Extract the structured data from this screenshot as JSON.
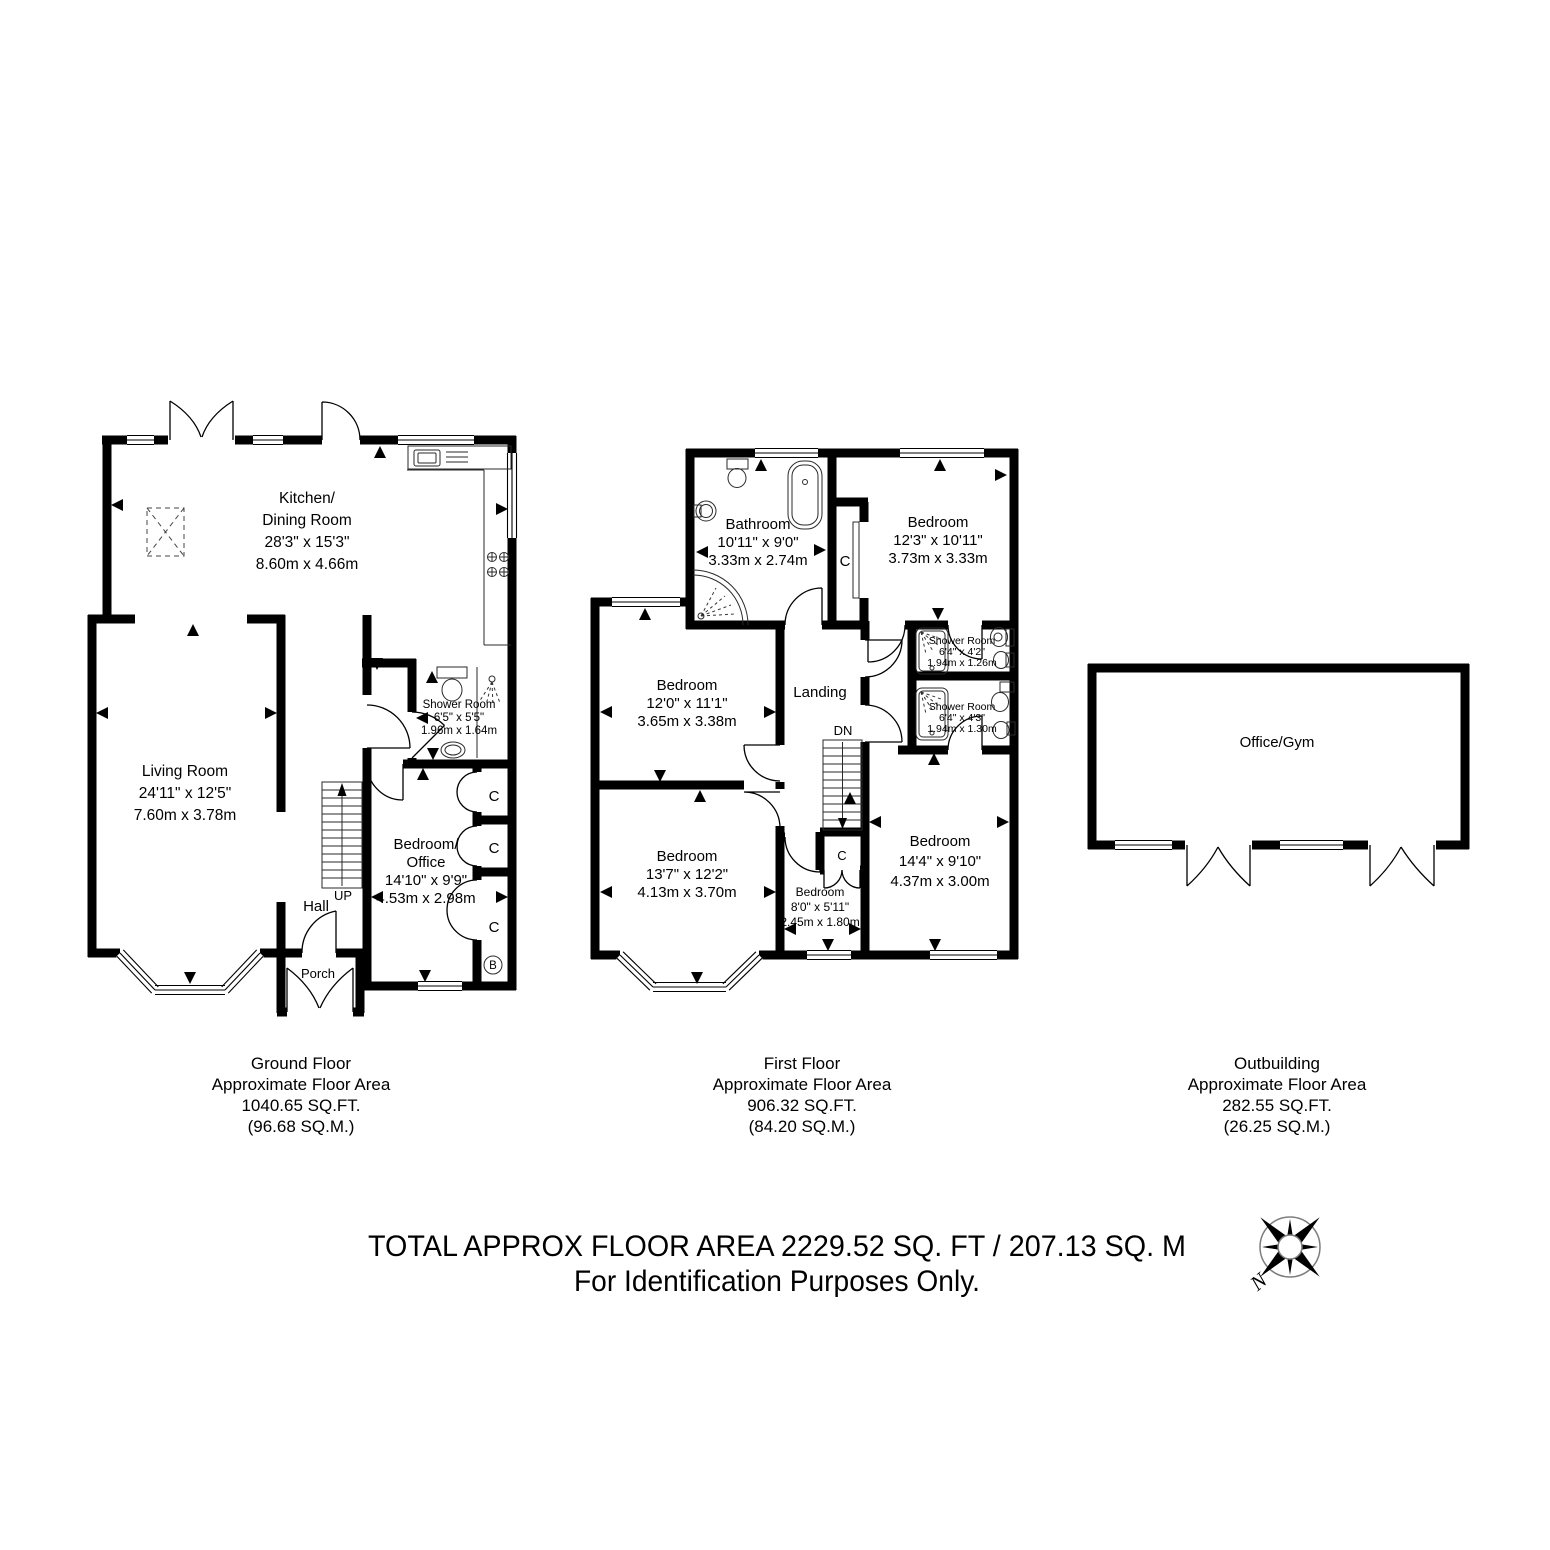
{
  "ground_floor": {
    "caption": {
      "title": "Ground Floor",
      "subtitle": "Approximate Floor Area",
      "area_ft": "1040.65 SQ.FT.",
      "area_m": "(96.68 SQ.M.)"
    },
    "rooms": {
      "kitchen_dining": {
        "name1": "Kitchen/",
        "name2": "Dining Room",
        "imperial": "28'3\" x 15'3\"",
        "metric": "8.60m x 4.66m"
      },
      "living_room": {
        "name": "Living Room",
        "imperial": "24'11\" x 12'5\"",
        "metric": "7.60m x 3.78m"
      },
      "shower_room": {
        "name": "Shower Room",
        "imperial": "6'5\" x 5'5\"",
        "metric": "1.96m x 1.64m"
      },
      "bedroom_office": {
        "name1": "Bedroom/",
        "name2": "Office",
        "imperial": "14'10\" x 9'9\"",
        "metric": "4.53m x 2.98m"
      },
      "hall": {
        "name": "Hall"
      },
      "porch": {
        "name": "Porch"
      }
    },
    "labels": {
      "stairs": "UP",
      "closet1": "C",
      "closet2": "C",
      "closet3": "C",
      "boiler": "B"
    }
  },
  "first_floor": {
    "caption": {
      "title": "First Floor",
      "subtitle": "Approximate Floor Area",
      "area_ft": "906.32 SQ.FT.",
      "area_m": "(84.20 SQ.M.)"
    },
    "rooms": {
      "bathroom": {
        "name": "Bathroom",
        "imperial": "10'11\" x 9'0\"",
        "metric": "3.33m x 2.74m"
      },
      "bedroom_rear": {
        "name": "Bedroom",
        "imperial": "12'3\" x 10'11\"",
        "metric": "3.73m x 3.33m"
      },
      "bedroom_mid": {
        "name": "Bedroom",
        "imperial": "12'0\" x 11'1\"",
        "metric": "3.65m x 3.38m"
      },
      "bedroom_front": {
        "name": "Bedroom",
        "imperial": "13'7\" x 12'2\"",
        "metric": "4.13m x 3.70m"
      },
      "bedroom_right": {
        "name": "Bedroom",
        "imperial": "14'4\" x 9'10\"",
        "metric": "4.37m x 3.00m"
      },
      "bedroom_small": {
        "name": "Bedroom",
        "imperial": "8'0\" x 5'11\"",
        "metric": "2.45m x 1.80m"
      },
      "shower_room1": {
        "name": "Shower Room",
        "imperial": "6'4\" x 4'2\"",
        "metric": "1.94m x 1.26m"
      },
      "shower_room2": {
        "name": "Shower Room",
        "imperial": "6'4\" x 4'3\"",
        "metric": "1.94m x 1.30m"
      },
      "landing": {
        "name": "Landing"
      }
    },
    "labels": {
      "stairs": "DN",
      "closet1": "C",
      "closet2": "C"
    }
  },
  "outbuilding": {
    "caption": {
      "title": "Outbuilding",
      "subtitle": "Approximate Floor Area",
      "area_ft": "282.55 SQ.FT.",
      "area_m": "(26.25 SQ.M.)"
    },
    "rooms": {
      "office_gym": {
        "name": "Office/Gym"
      }
    }
  },
  "footer": {
    "line1": "TOTAL APPROX FLOOR AREA 2229.52 SQ. FT / 207.13 SQ. M",
    "line2": "For Identification Purposes Only."
  },
  "compass": {
    "north_label": "N"
  }
}
